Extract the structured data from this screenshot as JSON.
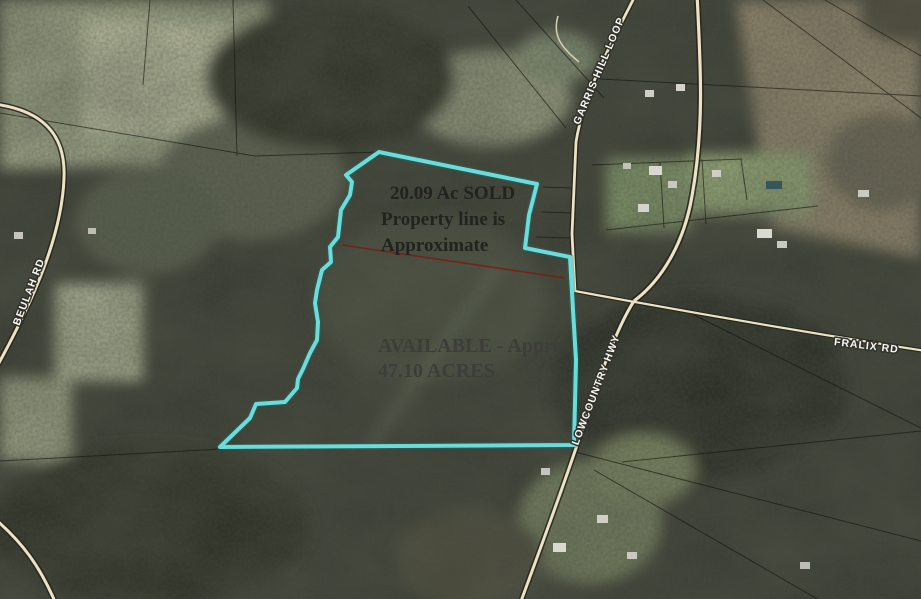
{
  "map": {
    "annotations": {
      "sold": {
        "line1": "20.09 Ac SOLD",
        "line2": "Property line is",
        "line3": "Approximate"
      },
      "available": {
        "line1": "AVAILABLE - Approx",
        "line2": "47.10 ACRES"
      }
    },
    "road_labels": {
      "garris_hill_loop": "GARRIS HILL LOOP",
      "beulah_rd": "BEULAH RD",
      "fralix_rd": "FRALIX RD",
      "lowcountry_hwy": "LOWCOUNTRY HWY"
    },
    "colors": {
      "boundary": "#6fe4e2",
      "sold_divider": "#7d1d12",
      "road_fill": "#eae2c6",
      "label_text": "#fafaf5"
    }
  }
}
